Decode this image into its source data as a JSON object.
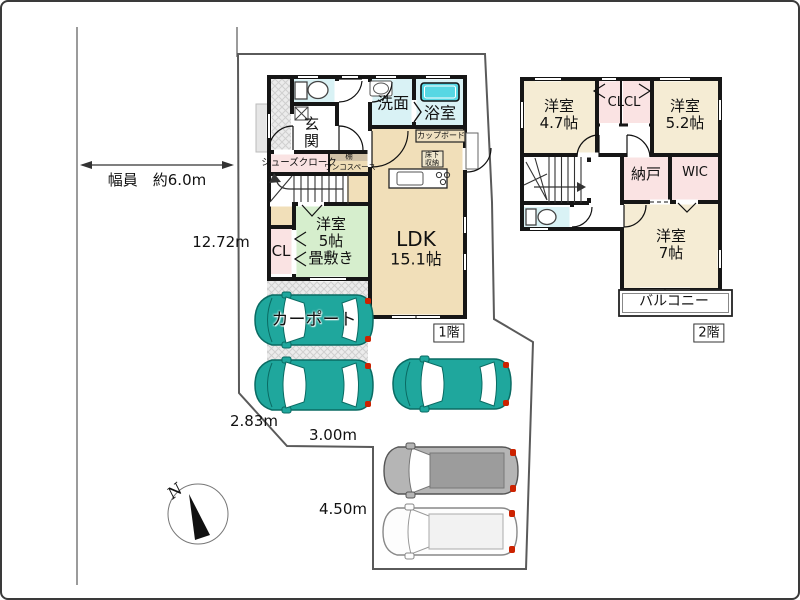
{
  "site": {
    "dimensions": {
      "road_width": "幅員　約6.0m",
      "west_side": "12.72m",
      "south_diag": "2.83m",
      "south_mid": "3.00m",
      "south_east": "4.50m"
    },
    "compass": {
      "north": "N"
    }
  },
  "floor1": {
    "badge": "1階",
    "rooms": {
      "genkan": "玄関",
      "senmen": "洗面",
      "bathroom": "浴室",
      "cupboard": "カップボード",
      "underfloor_line1": "床下",
      "underfloor_line2": "収納",
      "shoes_cloak": "シューズクローク",
      "shelf": "棚",
      "wanko_space": "ワンコスペース",
      "closet": "CL",
      "bedroom5_line1": "洋室",
      "bedroom5_line2": "5帖",
      "bedroom5_line3": "畳敷き",
      "ldk_line1": "LDK",
      "ldk_line2": "15.1帖",
      "carport": "カーポート"
    }
  },
  "floor2": {
    "badge": "2階",
    "rooms": {
      "bedroom47_line1": "洋室",
      "bedroom47_line2": "4.7帖",
      "closets": "CLCL",
      "bedroom52_line1": "洋室",
      "bedroom52_line2": "5.2帖",
      "storeroom": "納戸",
      "wic": "WIC",
      "bedroom7_line1": "洋室",
      "bedroom7_line2": "7帖",
      "balcony": "バルコニー"
    }
  },
  "colors": {
    "wall": "#161616",
    "room_tan": "#f1dfb9",
    "room_cream": "#f5ecd4",
    "room_green": "#d6eecd",
    "room_pink": "#fae3e3",
    "room_cyan": "#d9f2f5",
    "tub_teal": "#57d7e3",
    "car_teal": "#1fa79d",
    "boundary_gray": "#5a5a5a"
  }
}
